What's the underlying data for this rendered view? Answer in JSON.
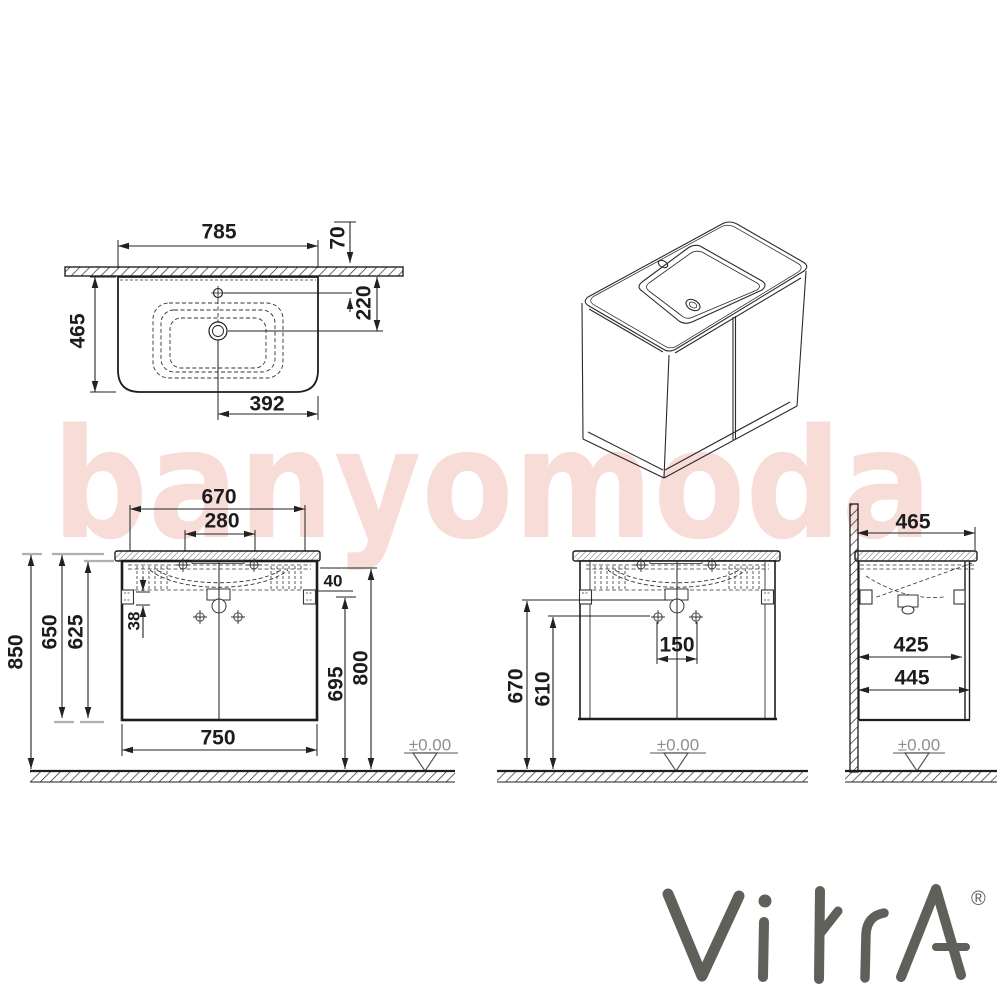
{
  "watermark": {
    "text": "banyomoda",
    "color": "#f8dcd8"
  },
  "brand": {
    "name": "VitrA",
    "registered": "®",
    "color": "#60605a"
  },
  "views": {
    "top": {
      "overall_width": "785",
      "faucet_to_wall": "70",
      "drain_to_wall": "220",
      "depth": "465",
      "drain_to_edge": "392"
    },
    "front": {
      "washbasin_width": "670",
      "faucet_spacing": "280",
      "overall_height": "850",
      "height_with_basin": "650",
      "cabinet_height": "625",
      "bracket_offset": "38",
      "clearance": "40",
      "door_height": "695",
      "mount_height": "800",
      "cabinet_width": "750",
      "ground": "±0.00"
    },
    "front2": {
      "siphon_height": "670",
      "drain_height": "610",
      "hole_spacing": "150",
      "ground": "±0.00"
    },
    "side": {
      "depth": "465",
      "cabinet_depth": "425",
      "overall_depth": "445",
      "ground": "±0.00"
    }
  }
}
